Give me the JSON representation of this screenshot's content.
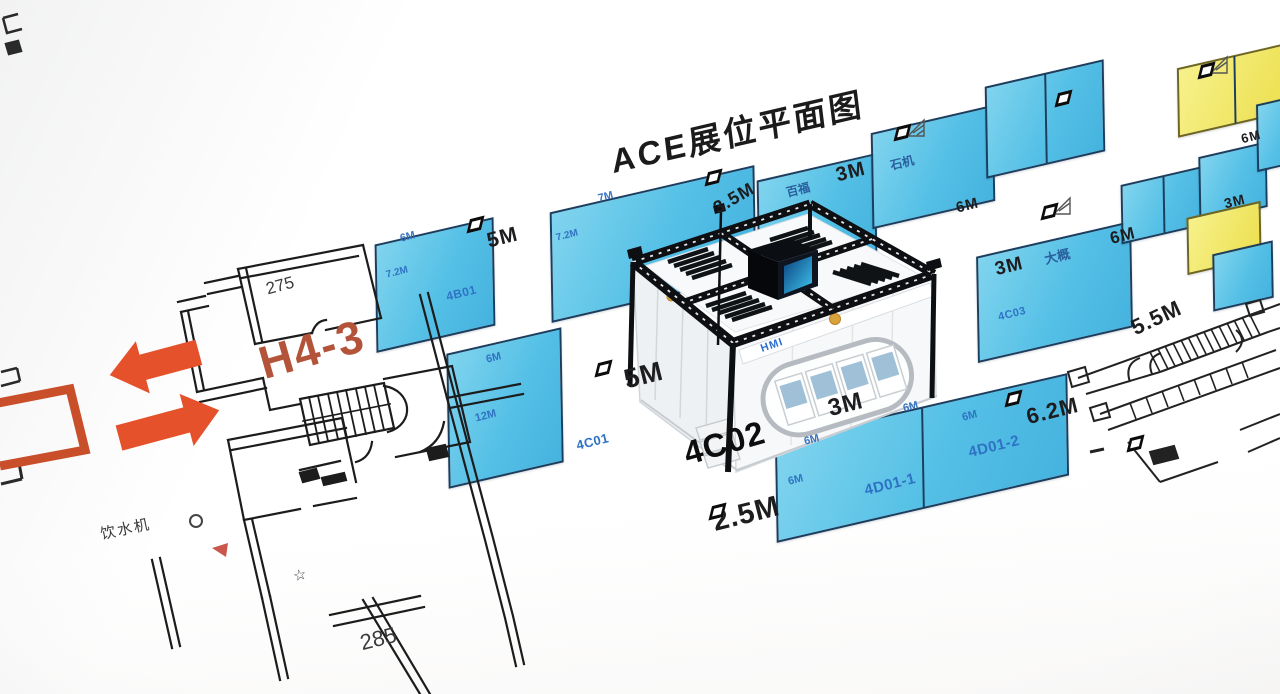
{
  "title": "ACE展位平面图",
  "hall_label": "H4-3",
  "highlight_booth": "4C02",
  "colors": {
    "booth_blue": "#55c0e6",
    "booth_yellow": "#eee04e",
    "booth_border": "#1c3e5e",
    "arrow_orange": "#e5512b",
    "hall_text_orange": "#b3543a",
    "booth_id_text": "#2f72c4"
  },
  "plan": {
    "room_upper": "275",
    "room_lower": "285",
    "water_dispenser": "饮水机",
    "star": "☆"
  },
  "booth_3d": {
    "sign_text": "HMI"
  },
  "dims": {
    "aisle_5m_upper": "5M",
    "aisle_5m_lower": "5M",
    "aisle_3_5m": "3.5M",
    "aisle_3m_top": "3M",
    "aisle_6m_top": "6M",
    "aisle_3m_mid": "3M",
    "aisle_6m_right": "6M",
    "aisle_3m_bottom": "3M",
    "aisle_2_5m": "2.5M",
    "aisle_6_2m": "6.2M",
    "aisle_5_5m": "5.5M",
    "aisle_6m_far": "6M",
    "aisle_3m_far": "3M"
  },
  "booths": {
    "b4b01": {
      "id": "4B01",
      "w": "6M",
      "h": "7.2M"
    },
    "b72": {
      "w": "7M",
      "h": "7.2M"
    },
    "b4c01": {
      "id": "4C01",
      "w": "6M",
      "h": "12M"
    },
    "b4d01_1": {
      "id": "4D01-1",
      "w": "6M",
      "h": "6M"
    },
    "b4d01_2": {
      "id": "4D01-2",
      "w": "6M",
      "h": "6M"
    },
    "e1": {
      "name": "百福"
    },
    "e2": {
      "name": "石机"
    },
    "f": {
      "id": "4C03",
      "name": "大概"
    }
  }
}
